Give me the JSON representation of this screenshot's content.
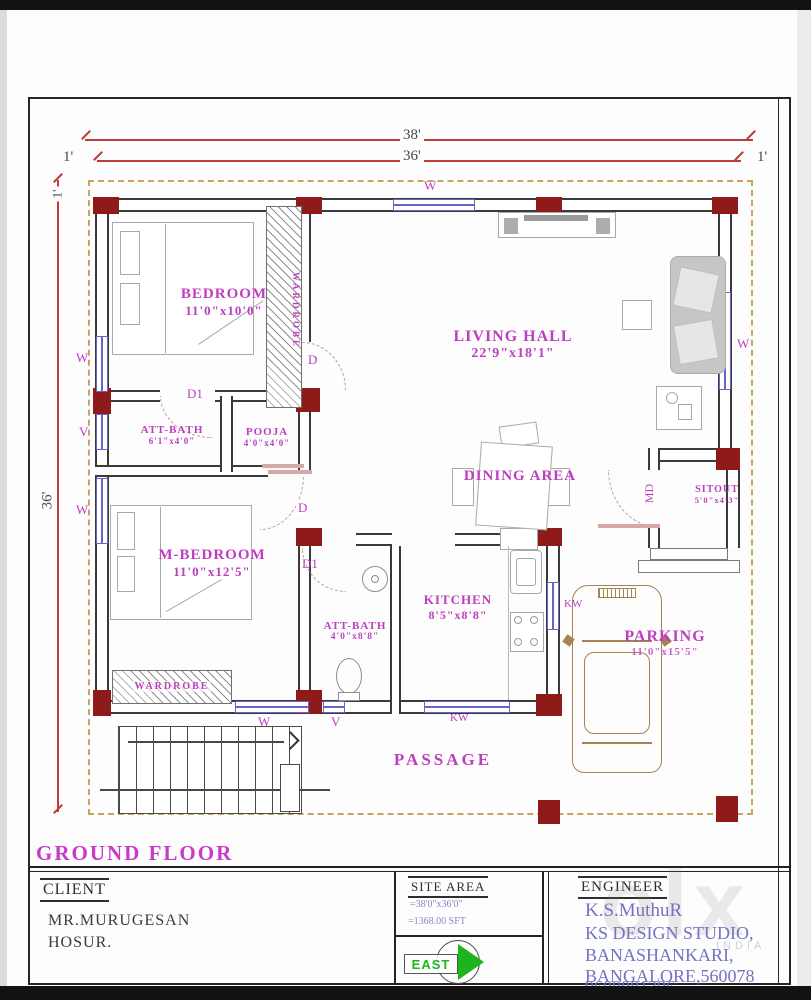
{
  "colors": {
    "label_magenta": "#bf3dbf",
    "dimension_red": "#c23b3b",
    "column_maroon": "#8e1a1a",
    "window_blue": "#6666c8",
    "boundary_tan": "#c9a35f",
    "east_green": "#1db51d",
    "engineer_blue": "#7272c4"
  },
  "dims": {
    "overall_width": "38'",
    "inner_width": "36'",
    "overall_depth": "36'",
    "setback_left": "1'",
    "setback_right": "1'",
    "setback_top": "1'"
  },
  "labels": {
    "w": "W",
    "v": "V",
    "kw": "KW",
    "d": "D",
    "d1": "D1",
    "md": "MD"
  },
  "rooms": {
    "bedroom": {
      "name": "BEDROOM",
      "size": "11'0\"x10'0\""
    },
    "att_bath1": {
      "name": "ATT-BATH",
      "size": "6'1\"x4'0\""
    },
    "pooja": {
      "name": "POOJA",
      "size": "4'0\"x4'0\""
    },
    "living": {
      "name": "LIVING HALL",
      "size": "22'9\"x18'1\""
    },
    "dining": {
      "name": "DINING AREA"
    },
    "m_bedroom": {
      "name": "M-BEDROOM",
      "size": "11'0\"x12'5\""
    },
    "att_bath2": {
      "name": "ATT-BATH",
      "size": "4'0\"x8'8\""
    },
    "kitchen": {
      "name": "KITCHEN",
      "size": "8'5\"x8'8\""
    },
    "sitout": {
      "name": "SITOUT",
      "size": "5'0\"x4'3\""
    },
    "parking": {
      "name": "PARKING",
      "size": "11'0\"x15'5\""
    },
    "passage": {
      "name": "PASSAGE"
    },
    "wardrobe": {
      "name": "WARDROBE"
    }
  },
  "floor_title": "GROUND FLOOR",
  "title_block": {
    "client": {
      "heading": "CLIENT",
      "line1": "MR.MURUGESAN",
      "line2": "HOSUR."
    },
    "site_area": {
      "heading": "SITE AREA",
      "line1": "=38'0\"x36'0\"",
      "line2": "=1368.00 SFT"
    },
    "east": {
      "label": "EAST"
    },
    "engineer": {
      "heading": "ENGINEER",
      "line1": "K.S.MuthuR",
      "line2": "KS DESIGN STUDIO,",
      "line3": "BANASHANKARI,",
      "line4": "BANGALORE,560078",
      "line5": "9608081306"
    }
  },
  "watermark": {
    "text": "olx",
    "country": "INDIA"
  }
}
